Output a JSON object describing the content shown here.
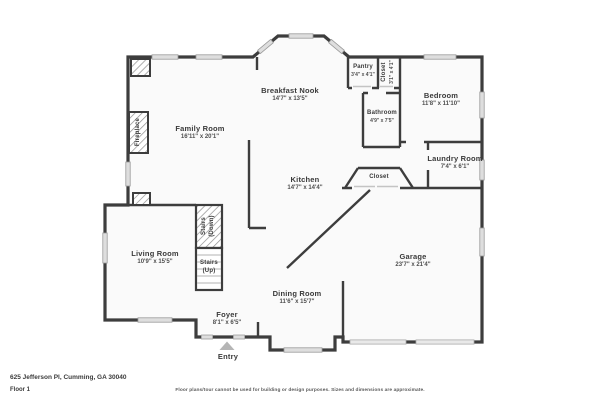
{
  "colors": {
    "wall": "#3d3d3d",
    "room_fill": "#fafafa",
    "window_fill": "#dedede",
    "garage_door_fill": "#e9e9e9",
    "hatch_line": "#8f8f8f",
    "entry_arrow": "#b5b5b5",
    "text": "#3a3a3a"
  },
  "rooms": {
    "breakfast_nook": {
      "name": "Breakfast Nook",
      "dims": "14'7\" x 13'5\""
    },
    "pantry": {
      "name": "Pantry",
      "dims": "3'4\" x 4'1\""
    },
    "closet_top": {
      "name": "Closet",
      "dims": "3'1\" x 4'1\""
    },
    "bedroom": {
      "name": "Bedroom",
      "dims": "11'8\" x 11'10\""
    },
    "bathroom": {
      "name": "Bathroom",
      "dims": "4'9\" x 7'5\""
    },
    "family_room": {
      "name": "Family Room",
      "dims": "16'11\" x 20'1\""
    },
    "fireplace": {
      "name": "Fireplace"
    },
    "laundry_room": {
      "name": "Laundry Room",
      "dims": "7'4\" x 6'1\""
    },
    "kitchen": {
      "name": "Kitchen",
      "dims": "14'7\" x 14'4\""
    },
    "closet_mid": {
      "name": "Closet"
    },
    "stairs_down": {
      "name": "Stairs",
      "sub": "(Down)"
    },
    "stairs_up": {
      "name": "Stairs",
      "sub": "(Up)"
    },
    "living_room": {
      "name": "Living Room",
      "dims": "10'9\" x 15'5\""
    },
    "garage": {
      "name": "Garage",
      "dims": "23'7\" x 21'4\""
    },
    "dining_room": {
      "name": "Dining Room",
      "dims": "11'6\" x 15'7\""
    },
    "foyer": {
      "name": "Foyer",
      "dims": "8'1\" x 6'5\""
    },
    "entry": {
      "name": "Entry"
    }
  },
  "footer": {
    "address": "625 Jefferson Pl, Cumming, GA 30040",
    "floor_label": "Floor 1",
    "disclaimer": "Floor plans/tour cannot be used for building or design purposes. Sizes and dimensions are approximate."
  }
}
